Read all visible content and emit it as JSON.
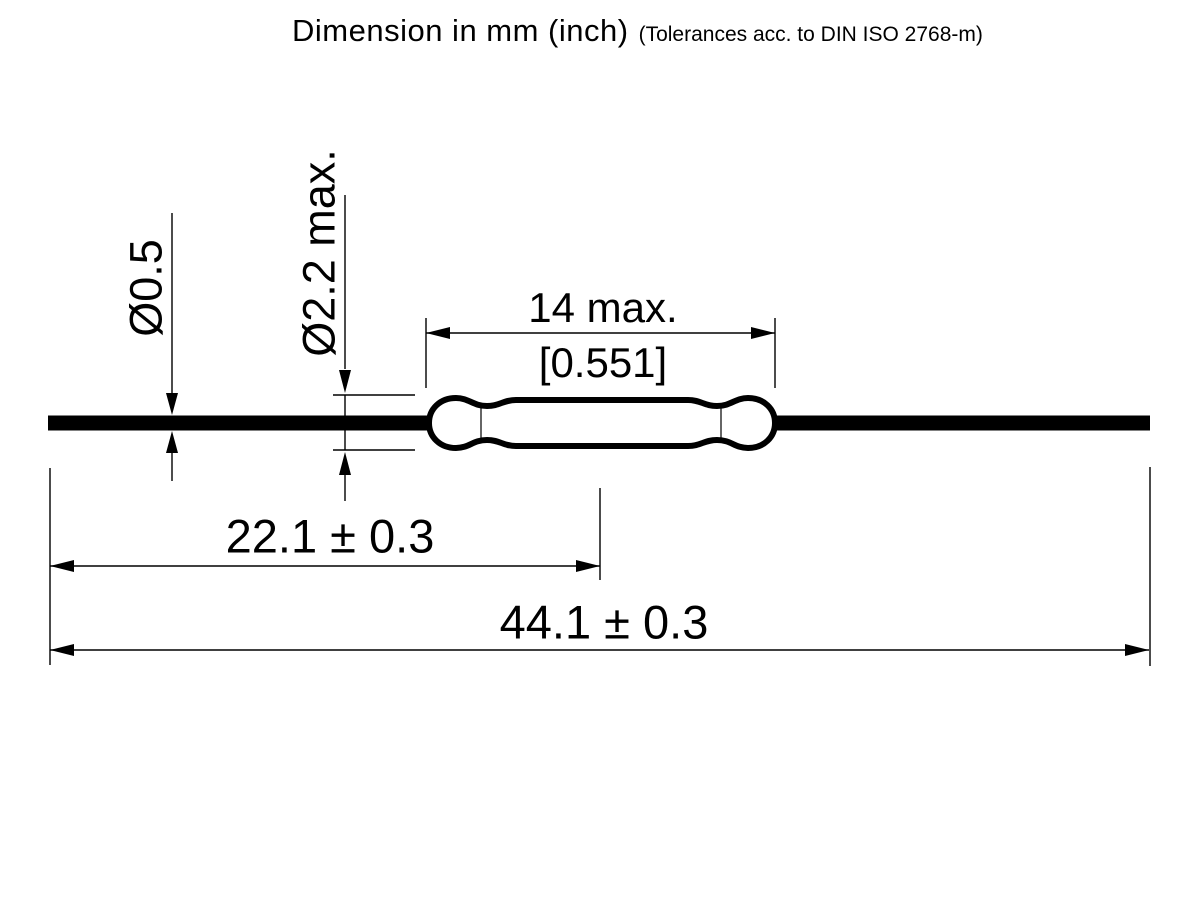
{
  "title": {
    "main": "Dimension in mm (inch)",
    "tolerance_note": "(Tolerances acc. to DIN ISO 2768-m)"
  },
  "dimensions": {
    "lead_diameter": "Ø0.5",
    "glass_diameter": "Ø2.2 max.",
    "glass_length": "14 max.",
    "glass_length_inch": "[0.551]",
    "lead_to_center": "22.1 ± 0.3",
    "total_length": "44.1 ± 0.3"
  },
  "colors": {
    "line": "#000000",
    "background": "#ffffff"
  }
}
